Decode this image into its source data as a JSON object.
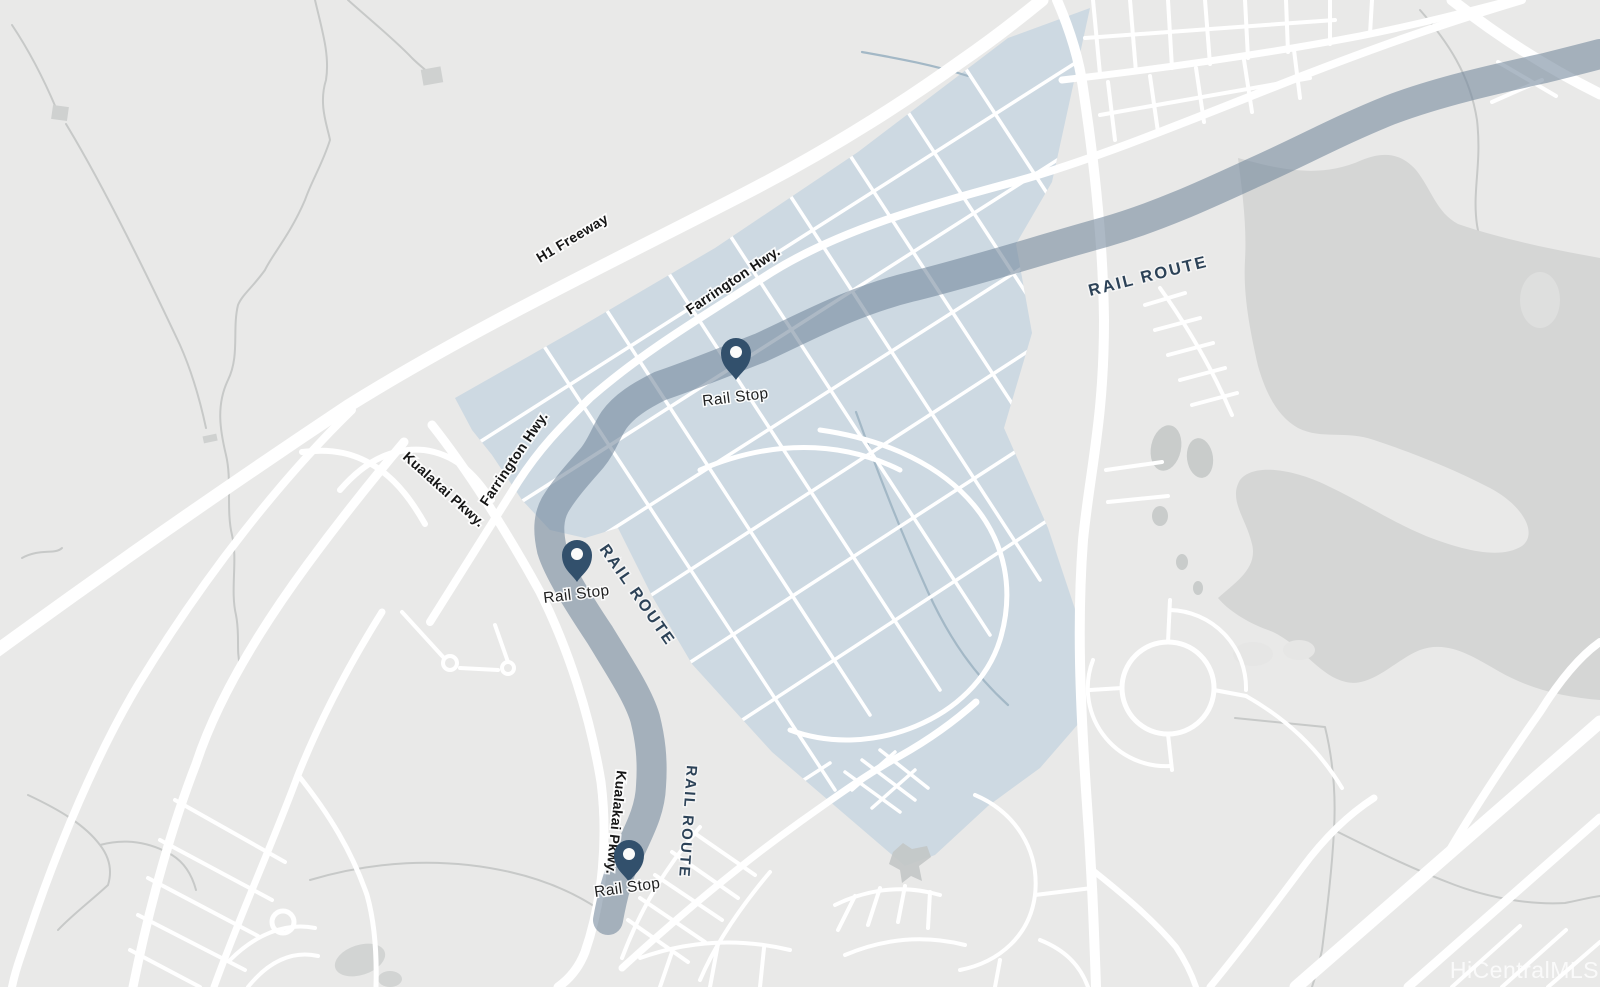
{
  "map": {
    "road_labels": {
      "h1_freeway": "H1 Freeway",
      "farrington_hwy_upper": "Farrington Hwy.",
      "farrington_hwy_lower": "Farrington Hwy.",
      "kualakai_pkwy_upper": "Kualakai Pkwy.",
      "kualakai_pkwy_lower": "Kualakai Pkwy."
    },
    "rail": {
      "route_labels": [
        "RAIL ROUTE",
        "RAIL ROUTE",
        "RAIL ROUTE"
      ],
      "stops": [
        {
          "label": "Rail Stop"
        },
        {
          "label": "Rail Stop"
        },
        {
          "label": "Rail Stop"
        }
      ]
    },
    "watermark": "HiCentralMLS",
    "colors": {
      "map_base": "#e9e9e8",
      "roads": "#ffffff",
      "development_area_fill": "#cdd9e2",
      "preserve_fill": "#d5d6d5",
      "rail_band": "#72879b",
      "rail_pin": "#32506c",
      "rail_text": "#2c4257",
      "label_text": "#161616",
      "watermark_text": "#ffffff"
    }
  }
}
